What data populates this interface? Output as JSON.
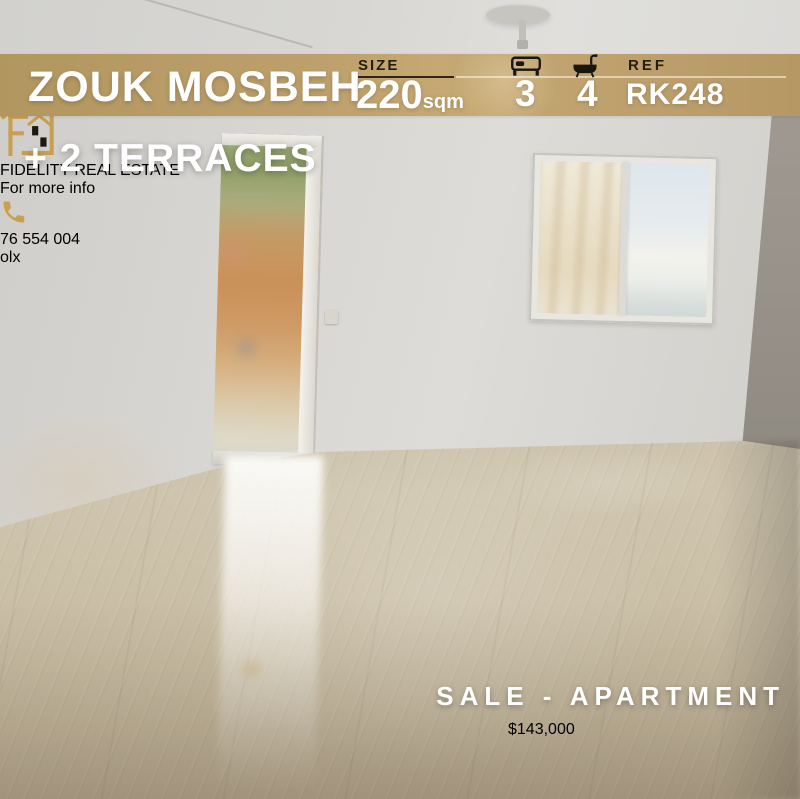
{
  "listing": {
    "location": "ZOUK MOSBEH",
    "extra_feature": "+ 2 TERRACES",
    "size": {
      "label": "SIZE",
      "value": "220",
      "unit": "sqm"
    },
    "bedrooms": {
      "icon": "bed-icon",
      "value": "3"
    },
    "bathrooms": {
      "icon": "bath-icon",
      "value": "4"
    },
    "reference": {
      "label": "REF",
      "value": "RK248"
    },
    "type_banner": "SALE - APARTMENT",
    "price": "$143,000"
  },
  "agency": {
    "name": "FIDELITY REAL ESTATE",
    "logo_icon": "gold-house-f-logo-icon",
    "contact_label": "For more info",
    "phone_icon": "phone-handset-icon",
    "phone_number": "76 554 004"
  },
  "watermark": {
    "text": "olx"
  },
  "icons": {
    "bed-icon": "black bed glyph",
    "bath-icon": "black bathtub glyph",
    "phone-handset-icon": "gold handset glyph",
    "gold-house-f-logo-icon": "gold outlined house with F monogram",
    "price-house-icon": "gold house with black checker windows",
    "ceiling-lamp": "gray disc pendant"
  },
  "colors": {
    "header_band_gold": "#bb9e6c",
    "price_band_gold": "#d9b765",
    "logo_gold": "#c89f52",
    "dark_text": "#1b1712",
    "white_text": "#ffffff"
  }
}
